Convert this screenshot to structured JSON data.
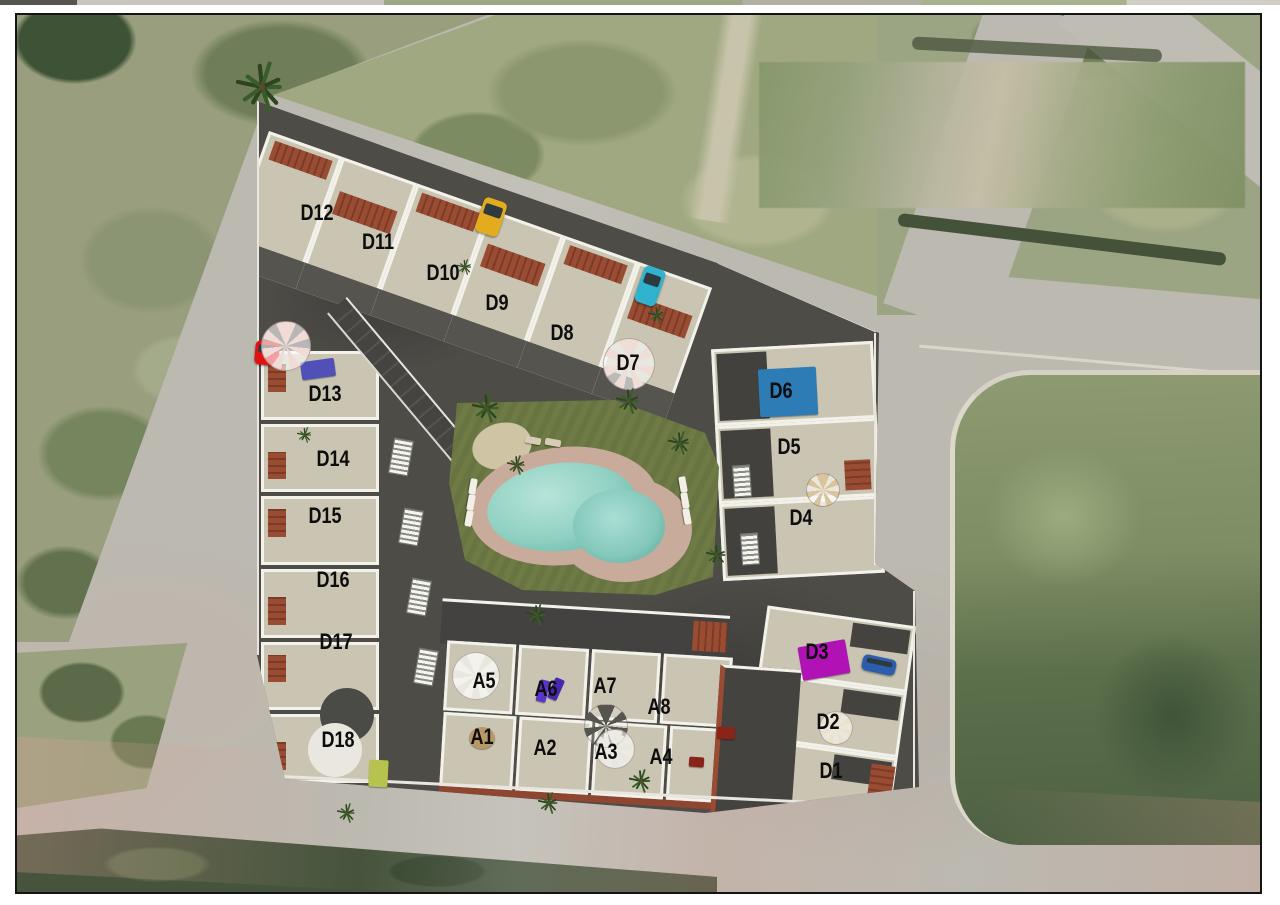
{
  "plan": {
    "kind": "residential-development-site-plan",
    "blocks": {
      "north-row": "D7-D12 townhouses along north road",
      "west-column": "D13-D18 townhouses along west edge",
      "east-block": "D4-D6 block along east road",
      "se-block": "D1-D3 block at southeast corner",
      "a-upper": "A5-A8 central row",
      "a-lower": "A1-A4 central row"
    }
  },
  "units": [
    {
      "id": "D12",
      "label": "D12",
      "block": "north-row",
      "x": 300,
      "y": 198
    },
    {
      "id": "D11",
      "label": "D11",
      "block": "north-row",
      "x": 361,
      "y": 227
    },
    {
      "id": "D10",
      "label": "D10",
      "block": "north-row",
      "x": 426,
      "y": 258
    },
    {
      "id": "D9",
      "label": "D9",
      "block": "north-row",
      "x": 480,
      "y": 288
    },
    {
      "id": "D8",
      "label": "D8",
      "block": "north-row",
      "x": 545,
      "y": 318
    },
    {
      "id": "D7",
      "label": "D7",
      "block": "north-row",
      "x": 611,
      "y": 348
    },
    {
      "id": "D13",
      "label": "D13",
      "block": "west-column",
      "x": 308,
      "y": 379
    },
    {
      "id": "D14",
      "label": "D14",
      "block": "west-column",
      "x": 316,
      "y": 444
    },
    {
      "id": "D15",
      "label": "D15",
      "block": "west-column",
      "x": 308,
      "y": 501
    },
    {
      "id": "D16",
      "label": "D16",
      "block": "west-column",
      "x": 316,
      "y": 565
    },
    {
      "id": "D17",
      "label": "D17",
      "block": "west-column",
      "x": 319,
      "y": 627
    },
    {
      "id": "D18",
      "label": "D18",
      "block": "west-column",
      "x": 321,
      "y": 725
    },
    {
      "id": "D6",
      "label": "D6",
      "block": "east-block",
      "x": 764,
      "y": 376
    },
    {
      "id": "D5",
      "label": "D5",
      "block": "east-block",
      "x": 772,
      "y": 432
    },
    {
      "id": "D4",
      "label": "D4",
      "block": "east-block",
      "x": 784,
      "y": 503
    },
    {
      "id": "D3",
      "label": "D3",
      "block": "se-block",
      "x": 800,
      "y": 637
    },
    {
      "id": "D2",
      "label": "D2",
      "block": "se-block",
      "x": 811,
      "y": 707
    },
    {
      "id": "D1",
      "label": "D1",
      "block": "se-block",
      "x": 814,
      "y": 756
    },
    {
      "id": "A5",
      "label": "A5",
      "block": "a-upper",
      "x": 467,
      "y": 666
    },
    {
      "id": "A6",
      "label": "A6",
      "block": "a-upper",
      "x": 529,
      "y": 674
    },
    {
      "id": "A7",
      "label": "A7",
      "block": "a-upper",
      "x": 588,
      "y": 671
    },
    {
      "id": "A8",
      "label": "A8",
      "block": "a-upper",
      "x": 642,
      "y": 692
    },
    {
      "id": "A1",
      "label": "A1",
      "block": "a-lower",
      "x": 465,
      "y": 722
    },
    {
      "id": "A2",
      "label": "A2",
      "block": "a-lower",
      "x": 528,
      "y": 733
    },
    {
      "id": "A3",
      "label": "A3",
      "block": "a-lower",
      "x": 589,
      "y": 737
    },
    {
      "id": "A4",
      "label": "A4",
      "block": "a-lower",
      "x": 644,
      "y": 742
    }
  ],
  "objects": [
    {
      "type": "rect",
      "name": "rooftop-pool-blue",
      "color": "#2d7cb5",
      "x": 742,
      "y": 353,
      "w": 58,
      "h": 48,
      "rot": -3
    },
    {
      "type": "rect",
      "name": "rooftop-pool-magenta",
      "color": "#b112b5",
      "x": 783,
      "y": 628,
      "w": 48,
      "h": 34,
      "rot": -10
    },
    {
      "type": "rect",
      "name": "blue-pergola",
      "color": "#5050b8",
      "x": 284,
      "y": 345,
      "w": 34,
      "h": 18,
      "rot": -8
    },
    {
      "type": "rect",
      "name": "purple-lounger",
      "color": "#5a35c8",
      "x": 521,
      "y": 665,
      "w": 10,
      "h": 22,
      "rot": 14
    },
    {
      "type": "rect",
      "name": "purple-lounger",
      "color": "#4628b0",
      "x": 534,
      "y": 663,
      "w": 10,
      "h": 22,
      "rot": 24
    },
    {
      "type": "rect",
      "name": "red-table",
      "color": "#8a2418",
      "x": 700,
      "y": 712,
      "w": 18,
      "h": 12,
      "rot": 4
    },
    {
      "type": "rect",
      "name": "red-table",
      "color": "#8a2418",
      "x": 672,
      "y": 742,
      "w": 15,
      "h": 10,
      "rot": 4
    },
    {
      "type": "rect",
      "name": "sand-patch",
      "color": "#b89868",
      "x": 452,
      "y": 712,
      "w": 26,
      "h": 22,
      "rot": 0,
      "round": true
    },
    {
      "type": "rect",
      "name": "green-canopy",
      "color": "#b8c24e",
      "x": 352,
      "y": 745,
      "w": 19,
      "h": 27,
      "rot": 3
    },
    {
      "type": "car",
      "name": "yellow-car",
      "color": "#e3ac1e",
      "x": 462,
      "y": 184,
      "w": 24,
      "h": 36,
      "rot": 19
    },
    {
      "type": "car",
      "name": "teal-car",
      "color": "#2fb3cf",
      "x": 622,
      "y": 252,
      "w": 22,
      "h": 38,
      "rot": 19
    },
    {
      "type": "car",
      "name": "red-car",
      "color": "#e01212",
      "x": 238,
      "y": 326,
      "w": 24,
      "h": 24,
      "rot": 5
    },
    {
      "type": "car",
      "name": "blue-car",
      "color": "#2b5fae",
      "x": 845,
      "y": 642,
      "w": 34,
      "h": 16,
      "rot": 12
    },
    {
      "type": "circle",
      "name": "dark-roof-circle",
      "color": "#4a4a46",
      "x": 330,
      "y": 700,
      "r": 27
    },
    {
      "type": "circle",
      "name": "white-round-terrace",
      "color": "#e9e7df",
      "x": 318,
      "y": 735,
      "r": 27
    },
    {
      "type": "umbrella",
      "name": "pink-umbrella",
      "color": "#f0dbd7",
      "x": 268,
      "y": 330,
      "r": 24
    },
    {
      "type": "umbrella",
      "name": "pink-umbrella",
      "color": "#efddd8",
      "x": 611,
      "y": 348,
      "r": 25
    },
    {
      "type": "umbrella",
      "name": "tan-umbrella",
      "color": "#d9c49c",
      "x": 805,
      "y": 474,
      "r": 16
    },
    {
      "type": "umbrella",
      "name": "cream-umbrella",
      "color": "#eae2cb",
      "x": 818,
      "y": 712,
      "r": 16
    },
    {
      "type": "umbrella",
      "name": "white-spiral-stair",
      "color": "#f4f2ec",
      "x": 458,
      "y": 660,
      "r": 23
    },
    {
      "type": "umbrella",
      "name": "gray-gazebo",
      "color": "#55544e",
      "x": 588,
      "y": 710,
      "r": 21,
      "flat": true
    },
    {
      "type": "umbrella",
      "name": "white-gazebo",
      "color": "#eceae2",
      "x": 597,
      "y": 733,
      "r": 19
    },
    {
      "type": "stairs",
      "name": "staircase",
      "x": 374,
      "y": 424,
      "w": 18,
      "h": 34,
      "rot": 10
    },
    {
      "type": "stairs",
      "name": "staircase",
      "x": 384,
      "y": 494,
      "w": 18,
      "h": 34,
      "rot": 10
    },
    {
      "type": "stairs",
      "name": "staircase",
      "x": 392,
      "y": 564,
      "w": 18,
      "h": 34,
      "rot": 10
    },
    {
      "type": "stairs",
      "name": "staircase",
      "x": 399,
      "y": 634,
      "w": 18,
      "h": 34,
      "rot": 10
    },
    {
      "type": "stairs",
      "name": "staircase",
      "x": 716,
      "y": 450,
      "w": 16,
      "h": 30,
      "rot": -4
    },
    {
      "type": "stairs",
      "name": "staircase",
      "x": 724,
      "y": 518,
      "w": 16,
      "h": 30,
      "rot": -4
    },
    {
      "type": "lounger",
      "name": "sun-lounger",
      "x": 448,
      "y": 468,
      "rot": 100
    },
    {
      "type": "lounger",
      "name": "sun-lounger",
      "x": 446,
      "y": 484,
      "rot": 100
    },
    {
      "type": "lounger",
      "name": "sun-lounger",
      "x": 444,
      "y": 500,
      "rot": 100
    },
    {
      "type": "lounger",
      "name": "sun-lounger",
      "x": 658,
      "y": 466,
      "rot": 80
    },
    {
      "type": "lounger",
      "name": "sun-lounger",
      "x": 660,
      "y": 482,
      "rot": 80
    },
    {
      "type": "lounger",
      "name": "sun-lounger",
      "x": 662,
      "y": 498,
      "rot": 80
    },
    {
      "type": "lounger",
      "name": "sun-lounger",
      "color": "#d8cdb4",
      "x": 508,
      "y": 422,
      "rot": 10
    },
    {
      "type": "lounger",
      "name": "sun-lounger",
      "color": "#d8cdb4",
      "x": 528,
      "y": 424,
      "rot": 10
    },
    {
      "type": "palm",
      "name": "palm-tree",
      "x": 245,
      "y": 72,
      "s": 52
    },
    {
      "type": "palm",
      "name": "palm-tree",
      "x": 470,
      "y": 393,
      "s": 30
    },
    {
      "type": "palm",
      "name": "palm-tree",
      "x": 612,
      "y": 386,
      "s": 26
    },
    {
      "type": "palm",
      "name": "palm-tree",
      "x": 663,
      "y": 428,
      "s": 24
    },
    {
      "type": "palm",
      "name": "palm-tree",
      "x": 500,
      "y": 450,
      "s": 20
    },
    {
      "type": "palm",
      "name": "palm-tree",
      "x": 700,
      "y": 540,
      "s": 22
    },
    {
      "type": "palm",
      "name": "palm-tree",
      "x": 520,
      "y": 600,
      "s": 22
    },
    {
      "type": "palm",
      "name": "palm-tree",
      "x": 624,
      "y": 766,
      "s": 24
    },
    {
      "type": "palm",
      "name": "palm-tree",
      "x": 532,
      "y": 788,
      "s": 22
    },
    {
      "type": "palm",
      "name": "palm-tree",
      "x": 330,
      "y": 798,
      "s": 20
    },
    {
      "type": "palm",
      "name": "palm-tree",
      "x": 288,
      "y": 420,
      "s": 16
    },
    {
      "type": "palm",
      "name": "palm-tree",
      "x": 640,
      "y": 300,
      "s": 18
    },
    {
      "type": "palm",
      "name": "palm-tree",
      "x": 448,
      "y": 252,
      "s": 16
    }
  ],
  "colors": {
    "site_paving": "#4e4c47",
    "building_roof": "#c9c5b2",
    "wall_white": "#f2f1ea",
    "terracotta": "#9a4c33",
    "lawn": "#6e7b45",
    "pool_water": "#8fd0c2",
    "pool_deck": "#c9ab9c",
    "rooftop_pool_blue": "#2d7cb5",
    "rooftop_pool_magenta": "#b112b5",
    "field_green": "#989e7e",
    "road_gray": "#bcb9b0",
    "label_color": "#0d0d0d",
    "frame_border": "#141414"
  }
}
